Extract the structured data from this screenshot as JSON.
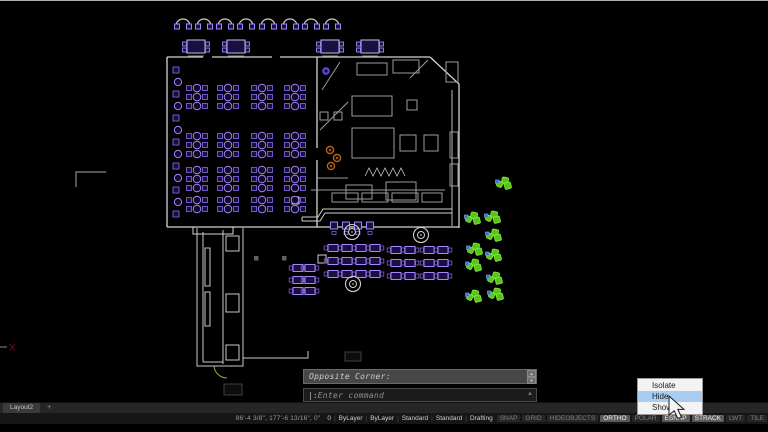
{
  "command": {
    "history_line": "Opposite Corner:",
    "prompt_prefix": "|:",
    "prompt": " Enter command"
  },
  "context_menu": {
    "items": [
      {
        "label": "Isolate",
        "highlighted": false
      },
      {
        "label": "Hide",
        "highlighted": true
      },
      {
        "label": "Show",
        "highlighted": false
      }
    ]
  },
  "layout_tabs": {
    "tabs": [
      "Layout2"
    ],
    "add_label": "+"
  },
  "status_bar": {
    "coordinates": "86'-4 3/8\", 177'-6 13/16\", 0\"",
    "fields": [
      "0",
      "ByLayer",
      "ByLayer",
      "Standard",
      "Standard",
      "Drafting"
    ],
    "toggles": [
      {
        "label": "SNAP",
        "active": false
      },
      {
        "label": "GRID",
        "active": false
      },
      {
        "label": "HIDEOBJECTS",
        "active": false
      },
      {
        "label": "ORTHO",
        "active": true
      },
      {
        "label": "POLAR",
        "active": false
      },
      {
        "label": "ESNAP",
        "active": true
      },
      {
        "label": "STRACK",
        "active": true
      },
      {
        "label": "LWT",
        "active": false
      },
      {
        "label": "TILE",
        "active": false
      }
    ]
  },
  "colors": {
    "wall": "#d4d4d4",
    "purple_stroke": "#7d5fd8",
    "purple_bright": "#a386ff",
    "purple_fill": "#1a0f40",
    "green": "#56c41a",
    "green_stroke": "#8aea40",
    "blue": "#3a72c8",
    "orange": "#c56a1d",
    "menu_highlight": "#a9cdf1"
  },
  "drawing": {
    "top_chairs_y": 18,
    "top_chairs": [
      183,
      204,
      225,
      246,
      268,
      290,
      311,
      332
    ],
    "top_tables": [
      [
        196,
        47
      ],
      [
        236,
        47
      ],
      [
        330,
        47
      ],
      [
        370,
        47
      ]
    ],
    "upper_cluster_cols": [
      197,
      228,
      262,
      295
    ],
    "upper_cluster_rows": [
      {
        "y": 88,
        "n": 3
      },
      {
        "y": 136,
        "n": 3
      },
      {
        "y": 170,
        "n": 3
      },
      {
        "y": 200,
        "n": 2
      }
    ],
    "wall_booths_x": 176,
    "wall_booths": [
      70,
      82,
      94,
      106,
      118,
      130,
      142,
      154,
      166,
      178,
      190,
      202,
      214
    ],
    "bar_stools": [
      334,
      346,
      358,
      370
    ],
    "lower_tables": [
      [
        298,
        268
      ],
      [
        298,
        280
      ],
      [
        298,
        291
      ],
      [
        310,
        268
      ],
      [
        310,
        280
      ],
      [
        310,
        291
      ],
      [
        333,
        248
      ],
      [
        333,
        261
      ],
      [
        333,
        274
      ],
      [
        347,
        248
      ],
      [
        347,
        261
      ],
      [
        347,
        274
      ],
      [
        361,
        248
      ],
      [
        361,
        261
      ],
      [
        361,
        274
      ],
      [
        375,
        248
      ],
      [
        375,
        261
      ],
      [
        375,
        274
      ],
      [
        396,
        250
      ],
      [
        396,
        263
      ],
      [
        396,
        276
      ],
      [
        410,
        250
      ],
      [
        410,
        263
      ],
      [
        410,
        276
      ],
      [
        429,
        250
      ],
      [
        429,
        263
      ],
      [
        429,
        276
      ],
      [
        443,
        250
      ],
      [
        443,
        263
      ],
      [
        443,
        276
      ]
    ],
    "columns": [
      [
        352,
        232
      ],
      [
        421,
        235
      ],
      [
        353,
        284
      ]
    ],
    "plants": [
      [
        503,
        184
      ],
      [
        472,
        219
      ],
      [
        492,
        218
      ],
      [
        493,
        236
      ],
      [
        474,
        250
      ],
      [
        493,
        256
      ],
      [
        473,
        266
      ],
      [
        494,
        279
      ],
      [
        473,
        297
      ],
      [
        495,
        295
      ]
    ],
    "orange_circles": [
      [
        330,
        150
      ],
      [
        337,
        158
      ],
      [
        331,
        166
      ]
    ],
    "purple_dot": [
      326,
      71
    ],
    "gray_dots": [
      [
        256,
        258
      ],
      [
        284,
        258
      ]
    ]
  }
}
